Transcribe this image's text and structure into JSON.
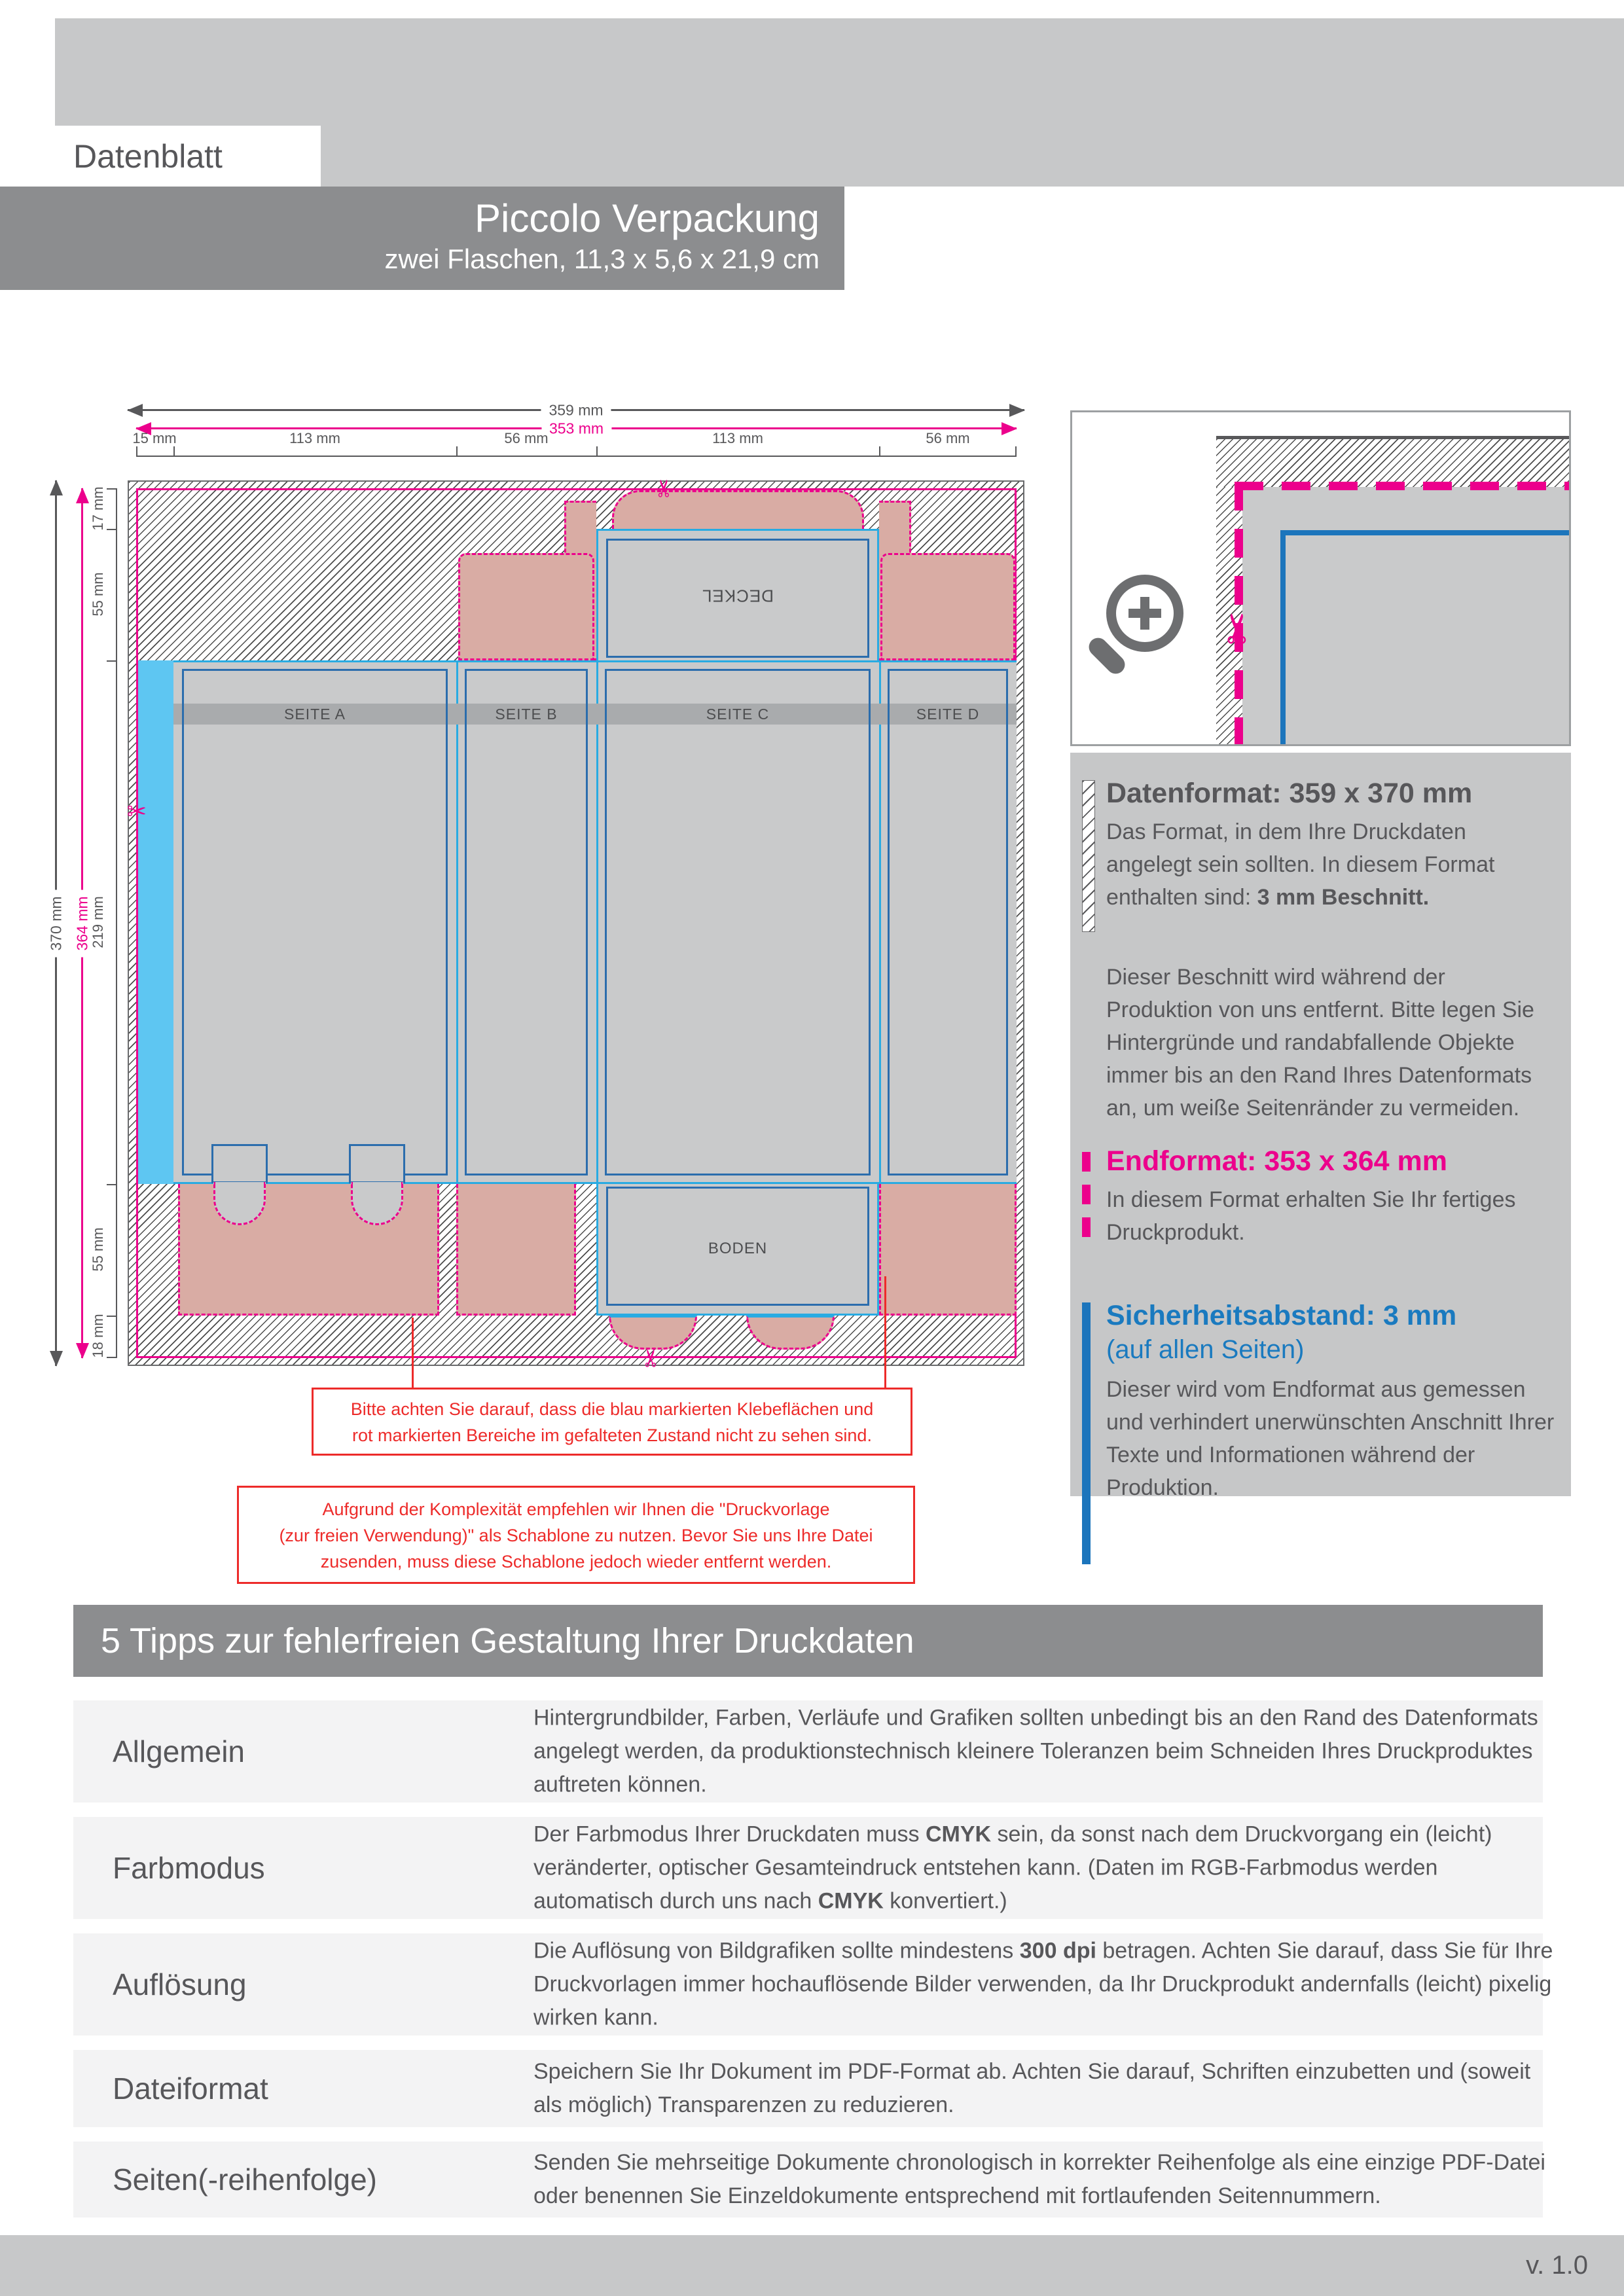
{
  "header": {
    "label": "Datenblatt",
    "product_title": "Piccolo Verpackung",
    "product_subtitle": "zwei Flaschen, 11,3 x 5,6 x 21,9 cm"
  },
  "colors": {
    "magenta": "#ec008c",
    "safety_blue": "#1c75bc",
    "fold_cyan": "#29abe2",
    "glue_cyan": "#5ec6f2",
    "warning_red": "#ed2b2a",
    "flap_pink": "#d9aca4",
    "panel_gray": "#c9cacb",
    "band_gray": "#8c8d8f",
    "text_gray": "#58585a"
  },
  "diagram": {
    "dims_top": {
      "outer": "359 mm",
      "inner": "353 mm",
      "segments": [
        "15 mm",
        "113 mm",
        "56 mm",
        "113 mm",
        "56 mm"
      ]
    },
    "dims_left": {
      "outer": "370 mm",
      "inner": "364 mm",
      "segments": [
        "17 mm",
        "55 mm",
        "219 mm",
        "55 mm",
        "18 mm"
      ]
    },
    "panels": {
      "deckel": "DECKEL",
      "seite_a": "SEITE A",
      "seite_b": "SEITE B",
      "seite_c": "SEITE C",
      "seite_d": "SEITE D",
      "boden": "BODEN"
    },
    "note_1": {
      "line1": "Bitte achten Sie darauf, dass die blau markierten Klebeflächen und",
      "line2": "rot markierten Bereiche im gefalteten Zustand nicht zu sehen sind."
    },
    "note_2": {
      "line1": "Aufgrund der Komplexität empfehlen wir Ihnen die \"Druckvorlage",
      "line2": "(zur freien Verwendung)\" als Schablone zu nutzen. Bevor Sie uns Ihre Datei",
      "line3": "zusenden, muss diese Schablone jedoch wieder entfernt werden."
    }
  },
  "info_panel": {
    "datenformat": {
      "title": "Datenformat: 359 x 370 mm",
      "body": "Das Format, in dem Ihre Druckdaten angelegt sein sollten. In diesem Format enthalten sind: ",
      "body_bold": "3 mm Beschnitt.",
      "paragraph": "Dieser Beschnitt wird während der Produktion von uns entfernt. Bitte legen Sie Hintergründe und randabfallende Objekte immer bis an den Rand Ihres Datenformats an, um weiße Seitenränder zu vermeiden."
    },
    "endformat": {
      "title": "Endformat: 353 x 364 mm",
      "body": "In diesem Format erhalten Sie Ihr fertiges Druckprodukt."
    },
    "sicherheitsabstand": {
      "title": "Sicherheitsabstand: 3 mm",
      "subtitle": "(auf allen Seiten)",
      "body": "Dieser wird vom Endformat aus gemessen und verhindert unerwünschten Anschnitt Ihrer Texte und Informationen während der Produktion."
    }
  },
  "tips": {
    "title": "5 Tipps zur fehlerfreien Gestaltung Ihrer Druckdaten",
    "rows": [
      {
        "label": "Allgemein",
        "s1": "Hintergrundbilder, Farben, Verläufe und Grafiken sollten unbedingt bis an den Rand des Datenformats angelegt werden, da produktionstechnisch kleinere Toleranzen beim Schneiden Ihres Druckproduktes auftreten können.",
        "b1": "",
        "s2": "",
        "b2": "",
        "s3": ""
      },
      {
        "label": "Farbmodus",
        "s1": "Der Farbmodus Ihrer Druckdaten muss ",
        "b1": "CMYK",
        "s2": " sein, da sonst nach dem Druckvorgang ein (leicht) veränderter, optischer Gesamteindruck entstehen kann. (Daten im RGB-Farbmodus werden automatisch durch uns nach ",
        "b2": "CMYK",
        "s3": " konvertiert.)"
      },
      {
        "label": "Auflösung",
        "s1": "Die Auflösung von Bildgrafiken sollte mindestens ",
        "b1": "300 dpi",
        "s2": " betragen. Achten Sie darauf, dass Sie für Ihre Druckvorlagen immer hochauflösende Bilder verwenden, da Ihr Druckprodukt andernfalls (leicht) pixelig wirken kann.",
        "b2": "",
        "s3": ""
      },
      {
        "label": "Dateiformat",
        "s1": "Speichern Sie Ihr Dokument im PDF-Format ab. Achten Sie darauf, Schriften einzubetten und (soweit als möglich) Transparenzen zu reduzieren.",
        "b1": "",
        "s2": "",
        "b2": "",
        "s3": ""
      },
      {
        "label": "Seiten(-reihenfolge)",
        "s1": "Senden Sie mehrseitige Dokumente chronologisch in korrekter Reihenfolge als eine einzige PDF-Datei oder benennen Sie Einzeldokumente entsprechend mit fortlaufenden Seitennummern.",
        "b1": "",
        "s2": "",
        "b2": "",
        "s3": ""
      }
    ]
  },
  "footer": {
    "version": "v. 1.0"
  }
}
